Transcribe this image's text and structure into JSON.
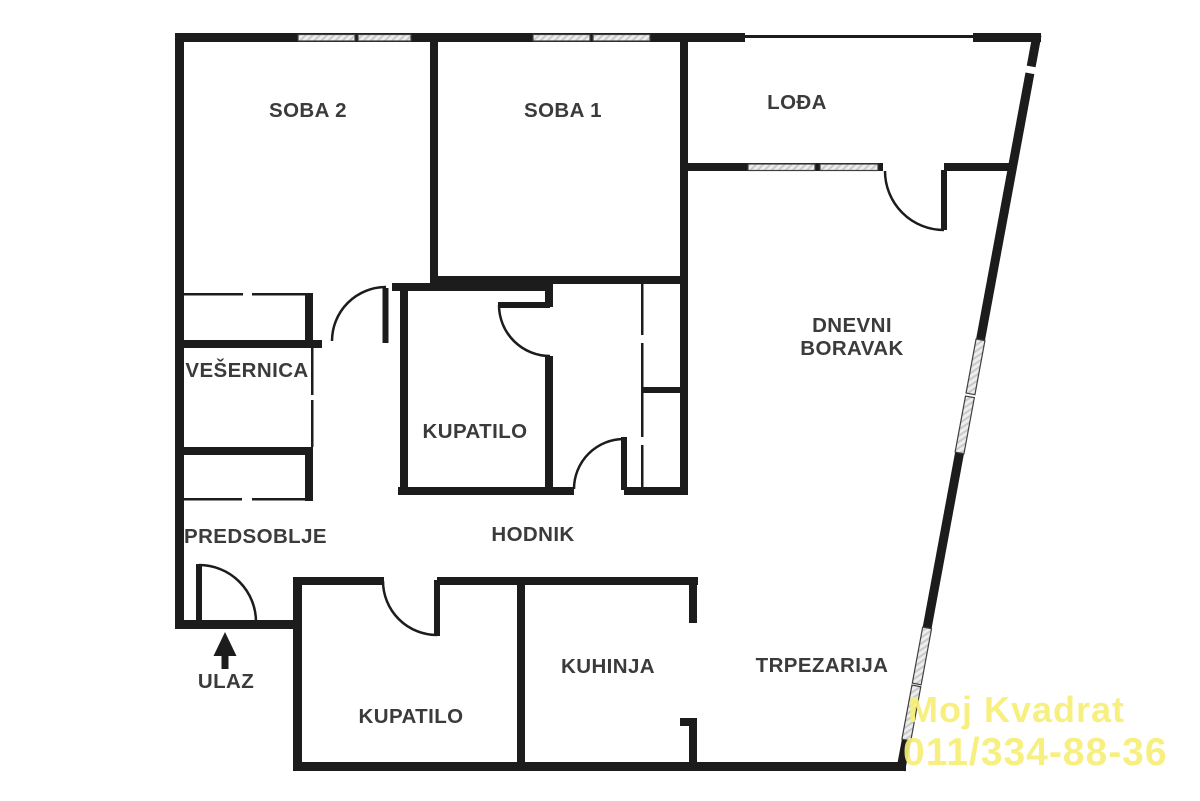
{
  "document": {
    "type": "apartment-floor-plan",
    "language": "Serbian"
  },
  "labels": {
    "soba2": "SOBA 2",
    "soba1": "SOBA 1",
    "lodja": "LOĐA",
    "dnevni_boravak": "DNEVNI\nBORAVAK",
    "vesernica": "VEŠERNICA",
    "kupatilo_upper": "KUPATILO",
    "predsoblje": "PREDSOBLJE",
    "hodnik": "HODNIK",
    "ulaz": "ULAZ",
    "kupatilo_lower": "KUPATILO",
    "kuhinja": "KUHINJA",
    "trpezarija": "TRPEZARIJA"
  },
  "watermark": {
    "line1": "Moj Kvadrat",
    "line2": "011/334-88-36",
    "color": "#f7ef76"
  },
  "colors": {
    "wall": "#1c1c1c",
    "label_text": "#3b3b3b",
    "background": "#ffffff",
    "window_fill": "#ededed",
    "window_hatch": "#c9c9c9"
  }
}
